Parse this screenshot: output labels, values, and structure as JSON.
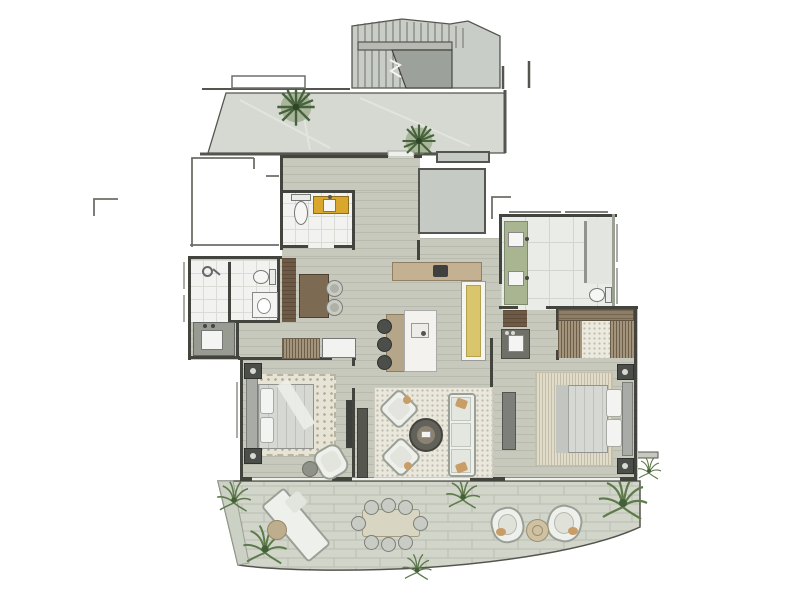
{
  "document": {
    "title": "Residential apartment floor plan",
    "view": "top-down rendered architectural plan, no text labels visible",
    "visible_text": []
  },
  "palette": {
    "background": "#ffffff",
    "walls": "#44443e",
    "wood_floor": "#c7c9bd",
    "tile_floor": "#f2f3f0",
    "stone_terrace": "#d5d9d1",
    "terrace_pavers": "#d2d5ca",
    "stair_concrete": "#c9cdc7",
    "stair_void": "#9da19b",
    "accent_yellow_vanity": "#d9a72c",
    "accent_olive_pantry": "#d8c56c",
    "vanity_green": "#a9b491",
    "dark_wood": "#6e5a45",
    "plant_green": "#47633c"
  },
  "rooms": {
    "staircase": {
      "label": "Common staircase with landing and break line"
    },
    "upper_terrace": {
      "label": "Upper terrace walkway with two planters"
    },
    "entry_hall": {
      "label": "Entry hall with wood flooring"
    },
    "service_core": {
      "label": "Service core shaft"
    },
    "powder_room": {
      "label": "Powder room",
      "fixtures": [
        "toilet",
        "yellow vanity with washbasin",
        "shelf plant"
      ]
    },
    "guest_bathroom": {
      "label": "Guest bathroom",
      "fixtures": [
        "walk-in shower",
        "toilet",
        "washbasin counter",
        "vanity with sink"
      ]
    },
    "study_nook": {
      "label": "Study nook",
      "furniture": [
        "dark wardrobe panel",
        "walnut desk",
        "two round chairs",
        "hanging closet",
        "storage bench"
      ]
    },
    "kitchen": {
      "label": "Kitchen",
      "furniture": [
        "wood counter with cooktop",
        "tall olive pantry unit",
        "marble island with sink",
        "three bar stools"
      ]
    },
    "living_room": {
      "label": "Living room",
      "furniture": [
        "speckled area rug",
        "two angled lounge chairs",
        "round coffee table",
        "three-seat sofa",
        "media console",
        "corner plant"
      ]
    },
    "bedroom_2": {
      "label": "Second bedroom",
      "furniture": [
        "double bed with headboard",
        "two nightstands",
        "shaggy rug",
        "armchair",
        "round ottoman",
        "wall TV panel"
      ]
    },
    "master_bathroom": {
      "label": "Master bathroom",
      "fixtures": [
        "green double vanity",
        "glass shower screen",
        "toilet"
      ]
    },
    "walk_in_closet": {
      "label": "Walk-in closet",
      "fixtures": [
        "hanging rails on both sides",
        "carpet runner"
      ]
    },
    "bar_niche": {
      "label": "Bar niche",
      "fixtures": [
        "dark cabinet",
        "sink vanity"
      ]
    },
    "master_bedroom": {
      "label": "Master bedroom",
      "furniture": [
        "double bed with headboard",
        "two nightstands",
        "textured rug",
        "dresser / TV unit"
      ]
    },
    "lower_terrace": {
      "label": "Curved lower terrace",
      "furniture": [
        "sun lounger",
        "round side table",
        "dining table with eight chairs",
        "two lounge chairs with round table",
        "planting beds with grasses"
      ]
    }
  },
  "summary": {
    "bedrooms": 2,
    "bathrooms": 3,
    "terraces": 2,
    "levels_shown": 1
  }
}
